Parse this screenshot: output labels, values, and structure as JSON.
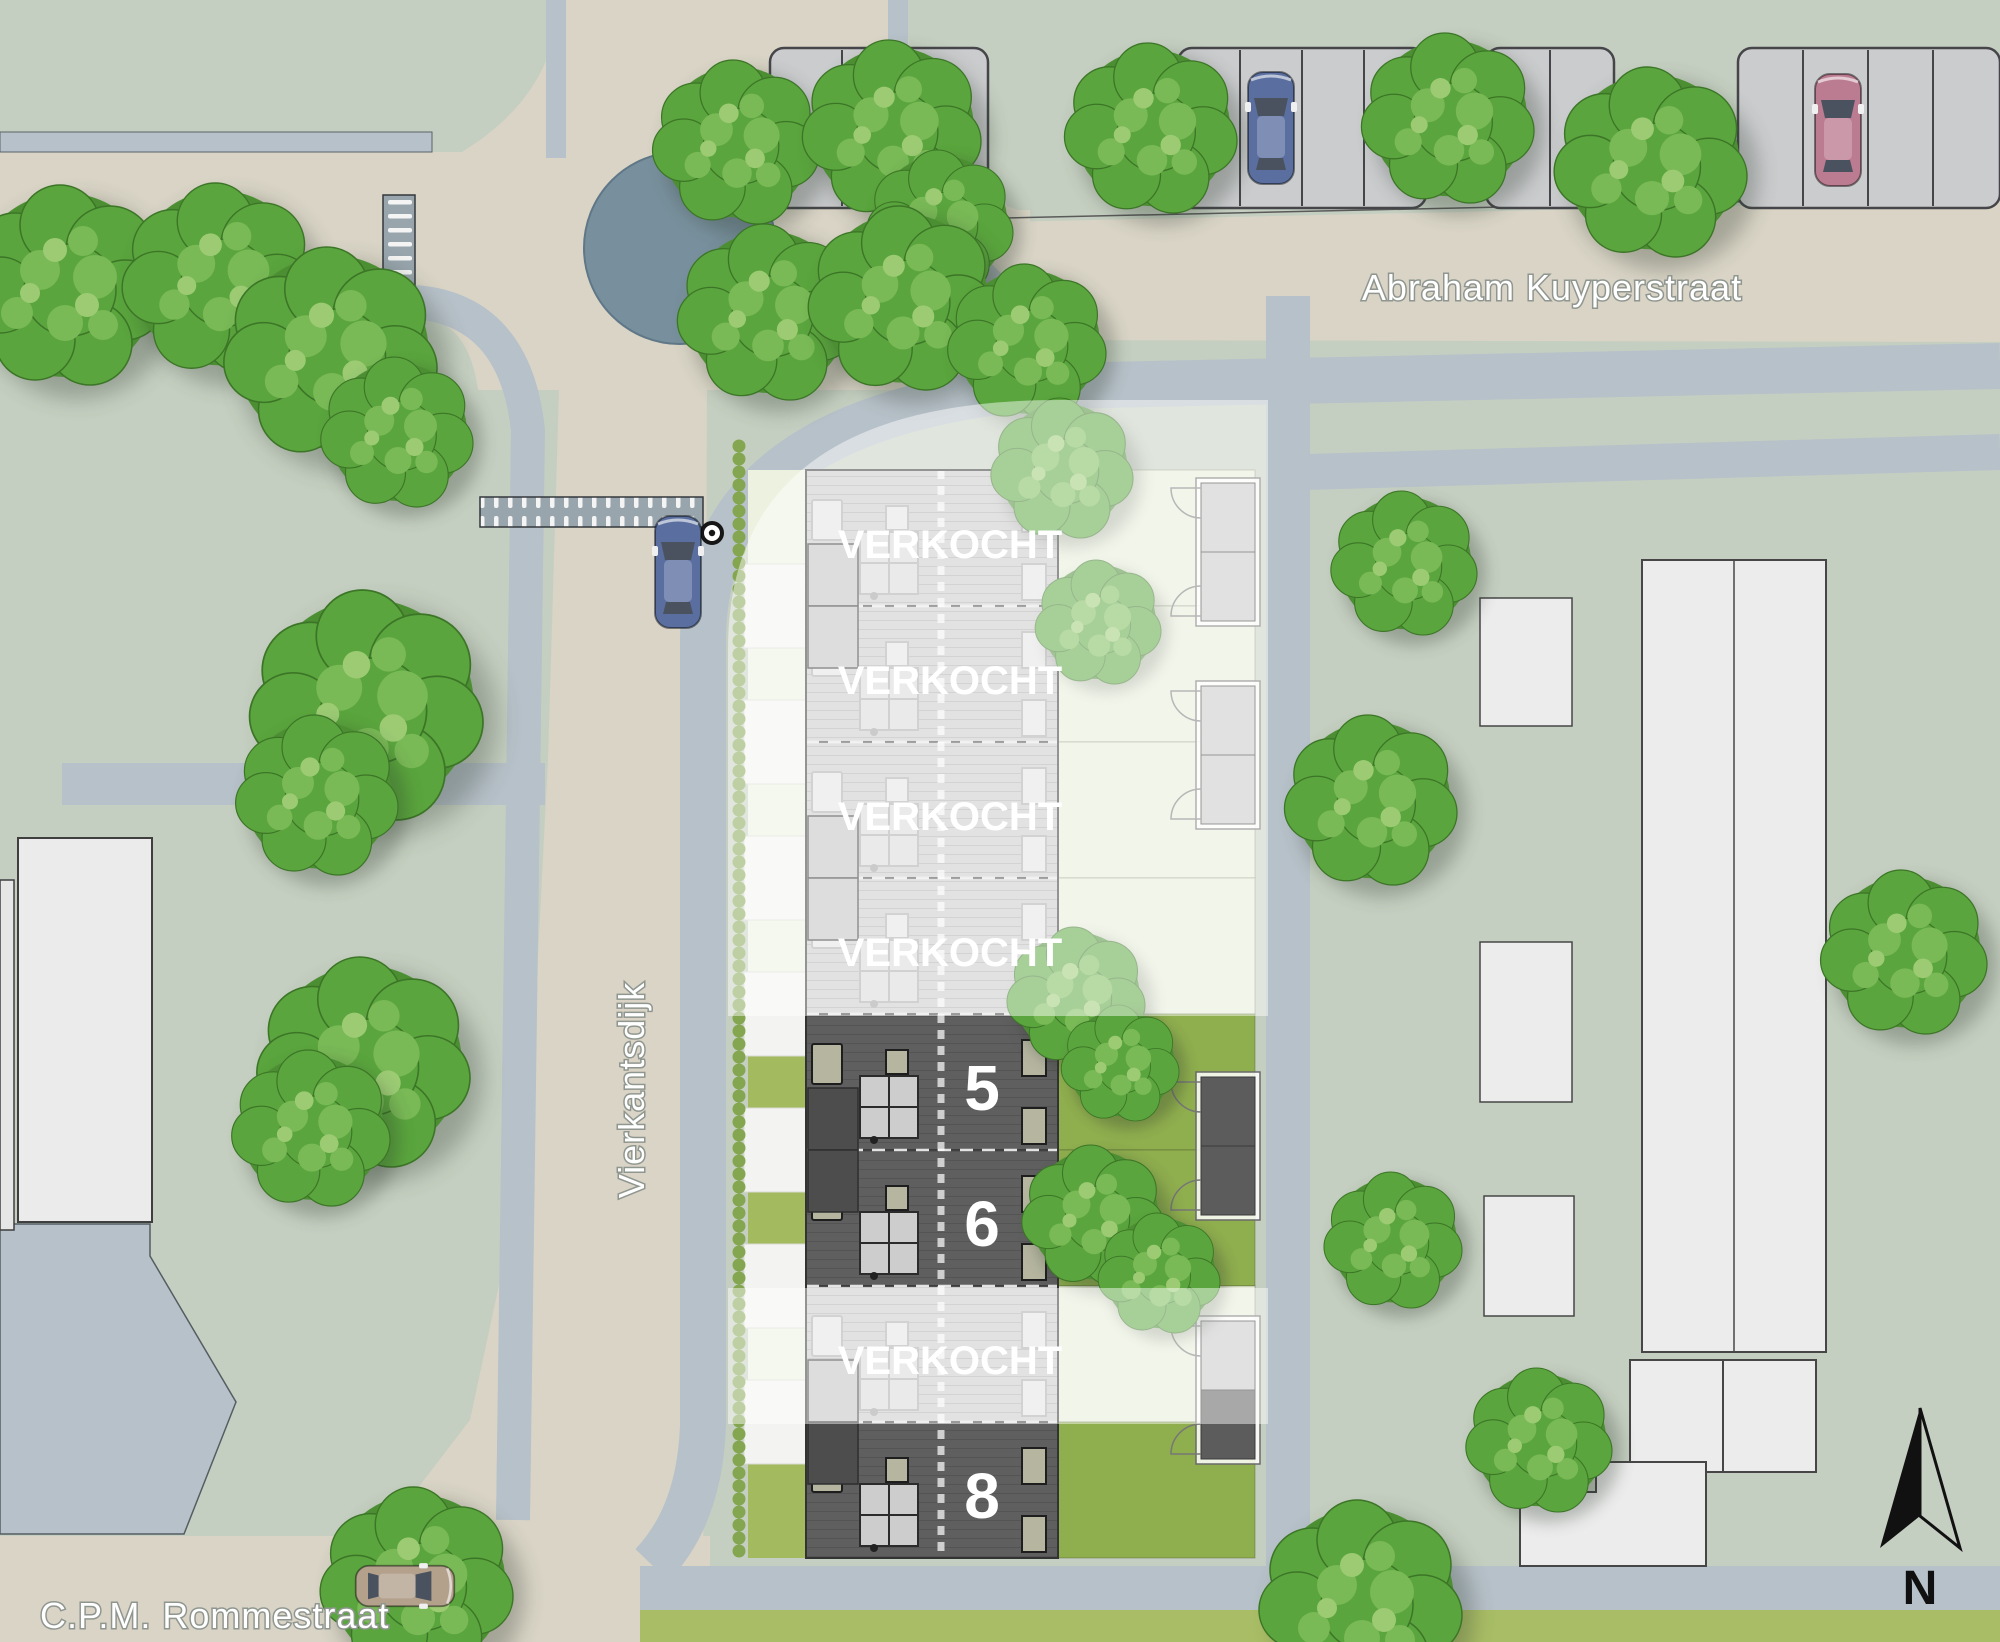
{
  "labels": {
    "street_top": "Abraham Kuyperstraat",
    "street_left": "Vierkantsdijk",
    "street_bottom": "C.P.M. Rommestraat",
    "north": "N"
  },
  "plots": [
    {
      "label": "VERKOCHT",
      "status": "sold"
    },
    {
      "label": "VERKOCHT",
      "status": "sold"
    },
    {
      "label": "VERKOCHT",
      "status": "sold"
    },
    {
      "label": "VERKOCHT",
      "status": "sold"
    },
    {
      "label": "5",
      "status": "available"
    },
    {
      "label": "6",
      "status": "available"
    },
    {
      "label": "VERKOCHT",
      "status": "sold"
    },
    {
      "label": "8",
      "status": "available"
    }
  ],
  "icons": [
    "north-arrow-icon",
    "tree-icon",
    "car-icon",
    "pedestrian-crossing-icon",
    "roundabout-island"
  ],
  "colors": {
    "background_green": "#c5cfc1",
    "road_beige": "#d9d4c6",
    "path_gray": "#b7c1c9",
    "roundabout_island": "#78909d",
    "available_roof": "#5f5f5f",
    "sold_roof": "#c9c9c9",
    "available_garden": "#8fae4e",
    "sold_garden": "#e7edd8",
    "olive_strip": "#a9bd66",
    "tree_green": "#57a23b",
    "car_blue": "#5a6f9f",
    "car_pink": "#bb7b90",
    "car_tan": "#b3a18c",
    "label_white": "#ffffff",
    "north_arrow_black": "#111111"
  }
}
